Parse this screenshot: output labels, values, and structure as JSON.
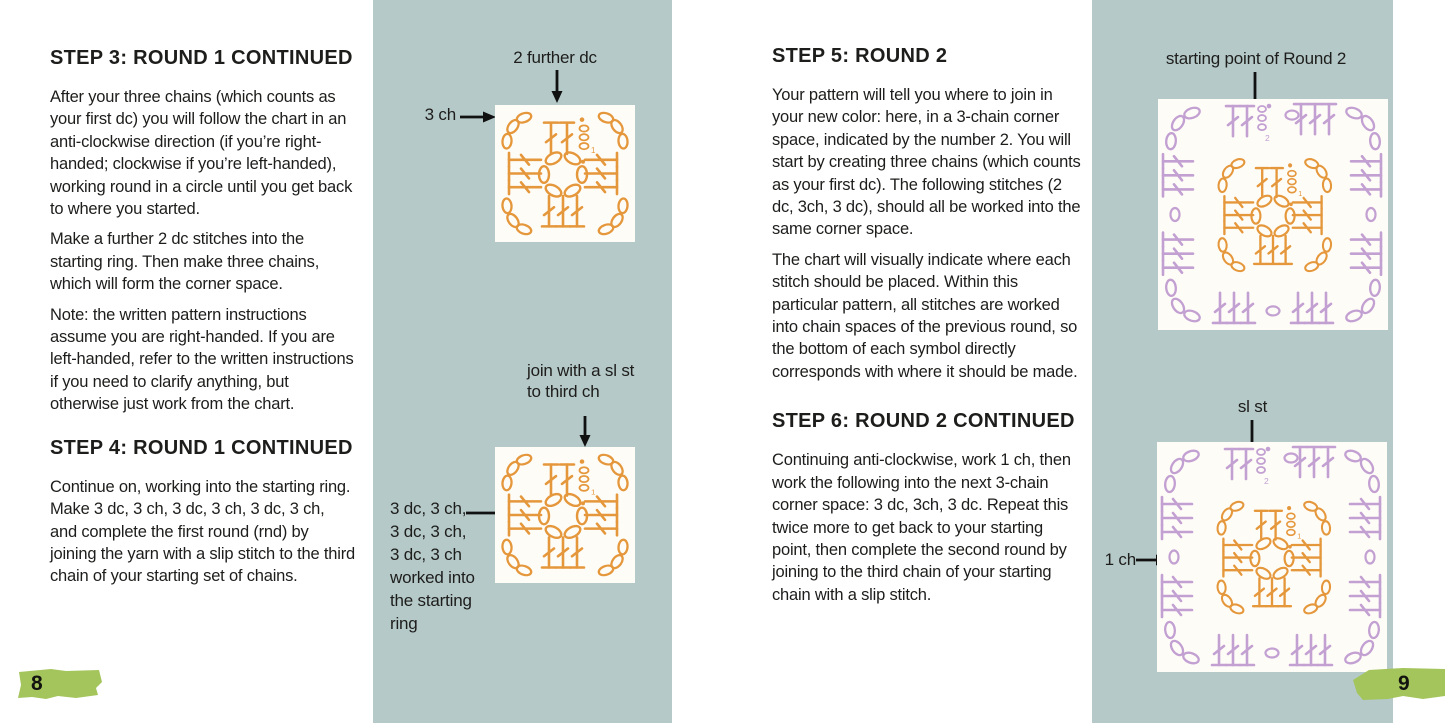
{
  "colors": {
    "page_background": "#ffffff",
    "panel_teal": "#b5c9c8",
    "round1_orange": "#e5973c",
    "round2_purple": "#c3a0d2",
    "badge_green": "#a4c55c",
    "text": "#1d1d1b",
    "chart_background": "#fefcf7",
    "arrow_black": "#111111"
  },
  "left_page": {
    "page_number": "8",
    "sections": [
      {
        "heading": "STEP 3: ROUND 1 CONTINUED",
        "paragraphs": [
          "After your three chains (which counts as your first dc) you will follow the chart in an anti-clockwise direction (if you’re right-handed; clockwise if you’re left-handed), working round in a circle until you get back to where you started.",
          "Make a further 2 dc stitches into the starting ring. Then make three chains, which will form the corner space.",
          "Note: the written pattern instructions assume you are right-handed. If you are left-handed, refer to the written instructions if you need to clarify anything, but otherwise just work from the chart."
        ]
      },
      {
        "heading": "STEP 4: ROUND 1 CONTINUED",
        "paragraphs": [
          "Continue on, working into the starting ring. Make 3 dc, 3 ch, 3 dc, 3 ch, 3 dc, 3 ch, and complete the first round (rnd) by joining the yarn with a slip stitch to the third chain of your starting set of chains."
        ]
      }
    ],
    "figures": [
      {
        "id": "round-1-in-progress",
        "label_top": "2 further dc",
        "label_left": "3 ch"
      },
      {
        "id": "round-1-complete",
        "label_top": "join with a sl st\nto third ch",
        "label_left": "3 dc, 3 ch,\n3 dc, 3 ch,\n3 dc, 3 ch\nworked into\nthe starting ring"
      }
    ]
  },
  "right_page": {
    "page_number": "9",
    "sections": [
      {
        "heading": "STEP 5: ROUND 2",
        "paragraphs": [
          "Your pattern will tell you where to join in your new color: here, in a 3-chain corner space, indicated by the number 2. You will start by creating three chains (which counts as your first dc). The following stitches (2 dc, 3ch, 3 dc), should all be worked into the same corner space.",
          "The chart will visually indicate where each stitch should be placed. Within this particular pattern, all stitches are worked into chain spaces of the previous round, so the bottom of each symbol directly corresponds with where it should be made."
        ]
      },
      {
        "heading": "STEP 6: ROUND 2 CONTINUED",
        "paragraphs": [
          "Continuing anti-clockwise, work 1 ch, then work the following into the next 3-chain corner space: 3 dc, 3ch, 3 dc. Repeat this twice more to get back to your starting point, then complete the second round by joining to the third chain of your starting chain with a slip stitch."
        ]
      }
    ],
    "figures": [
      {
        "id": "round-2-start",
        "label_top": "starting point of Round 2"
      },
      {
        "id": "round-2-complete",
        "label_top": "sl st",
        "label_left": "1 ch"
      }
    ]
  },
  "chart_markers": {
    "round_1_start": "1",
    "round_2_start": "2"
  }
}
